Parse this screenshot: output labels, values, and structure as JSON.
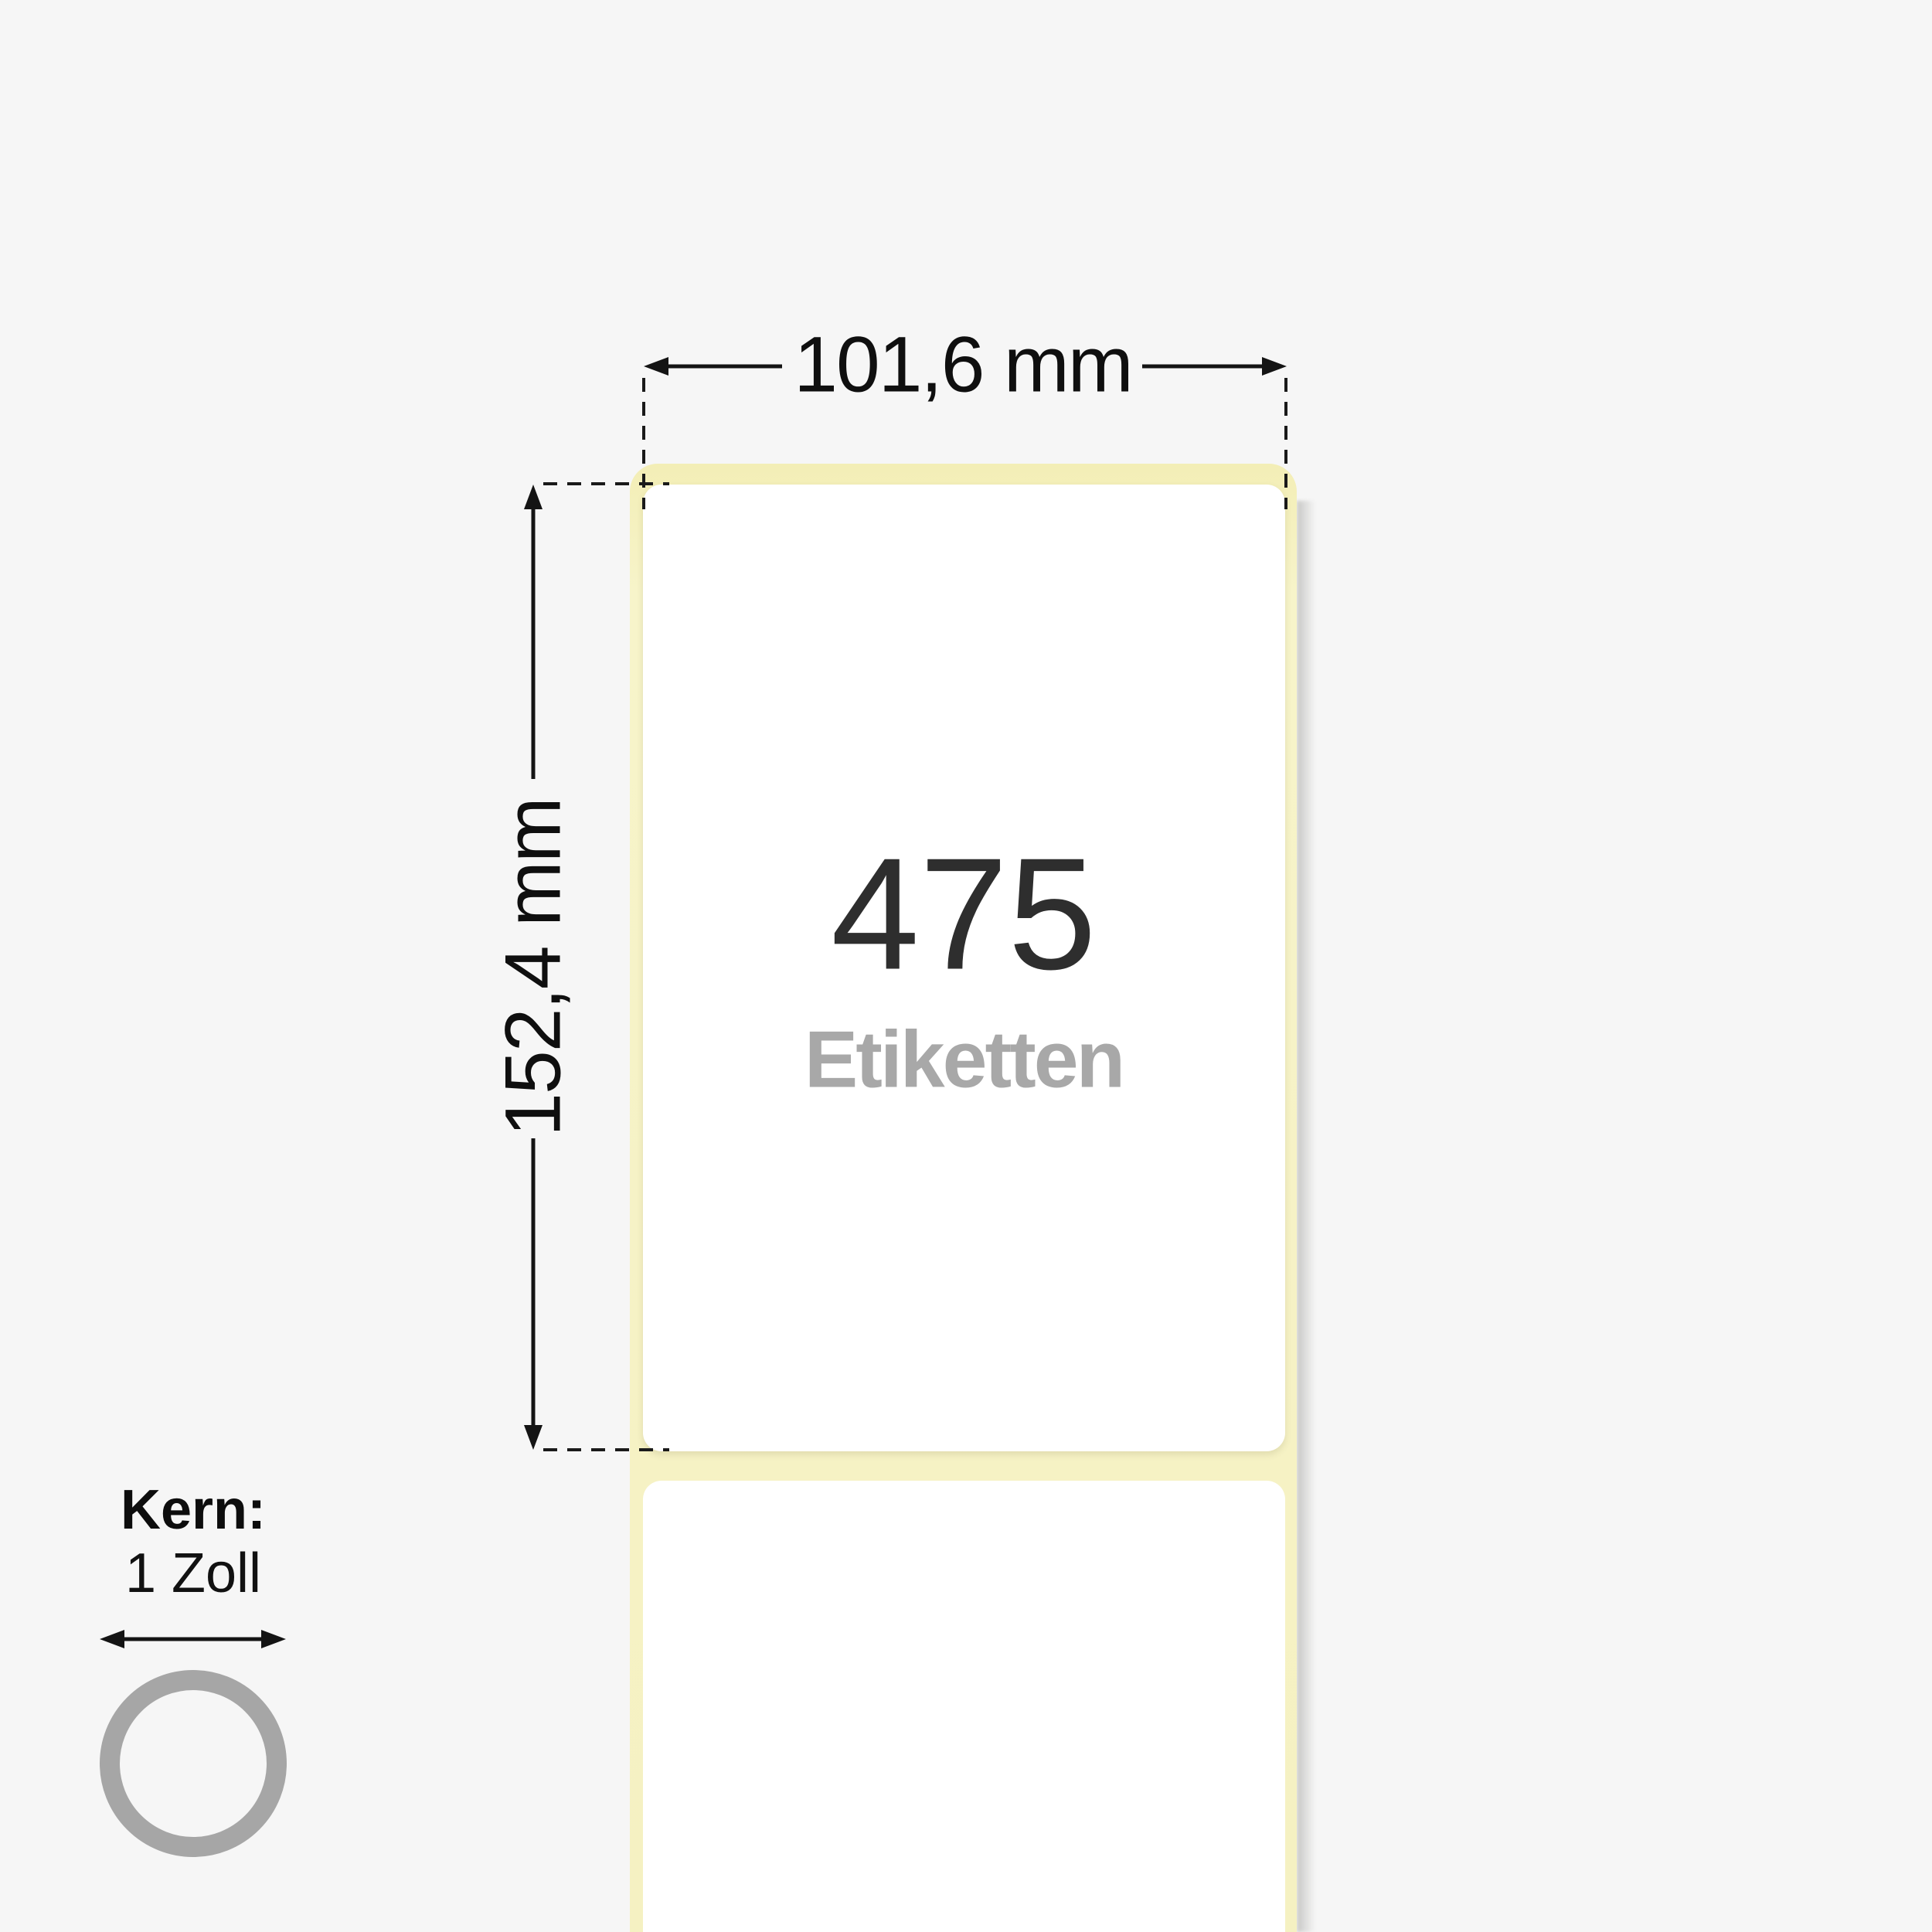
{
  "scene": {
    "type": "thermal-label-roll-product-diagram",
    "background": "#f6f6f6"
  },
  "dimension_width": {
    "label": "101,6 mm"
  },
  "dimension_height": {
    "label": "152,4 mm"
  },
  "label_count": {
    "value": "475",
    "unit": "Etiketten"
  },
  "core": {
    "title": "Kern:",
    "value": "1 Zoll"
  },
  "colors": {
    "background": "#f6f6f6",
    "liner_yellow": "#f6f2c5",
    "label_white": "#ffffff",
    "count_text": "#2e2e2e",
    "unit_text": "#a8a8a8",
    "dimension_line": "#141414",
    "core_ring": "#a6a6a6"
  },
  "icons": {
    "width_arrows": "left-right-arrow-icons",
    "height_arrows": "up-down-arrow-icons",
    "core_arrow": "double-headed-arrow-icon",
    "core_ring": "core-ring-icon"
  }
}
